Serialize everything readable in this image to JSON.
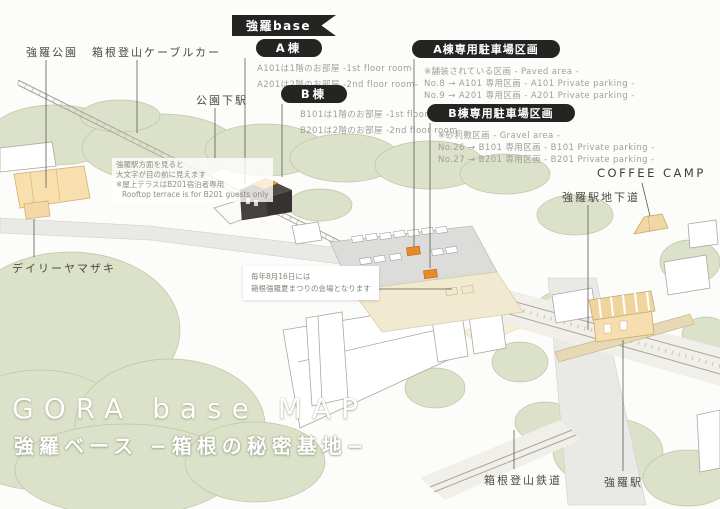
{
  "banner": {
    "title": "強羅base"
  },
  "legend": {
    "building_a": {
      "label": "A棟",
      "lines": [
        "A101は1階のお部屋 -1st floor room-",
        "A201は2階のお部屋 -2nd floor room-"
      ]
    },
    "building_b": {
      "label": "B棟",
      "lines": [
        "B101は1階のお部屋 -1st floor room-",
        "B201は2階のお部屋 -2nd floor room-"
      ]
    },
    "parking_a": {
      "label": "A棟専用駐車場区画",
      "lines": [
        "※舗装されている区画 - Paved area -",
        "No.8 → A101 専用区画  - A101 Private parking -",
        "No.9 → A201 専用区画  - A201 Private parking -"
      ]
    },
    "parking_b": {
      "label": "B棟専用駐車場区画",
      "lines": [
        "※砂利敷区画 - Gravel area -",
        "No.26 → B101 専用区画  - B101 Private parking -",
        "No.27 → B201 専用区画  - B201 Private parking -"
      ]
    }
  },
  "landmarks": {
    "gora_park": "強羅公園",
    "cable_car": "箱根登山ケーブルカー",
    "koen_shimo_station": "公園下駅",
    "daily_yamazaki": "デイリーヤマザキ",
    "coffee_camp": "COFFEE CAMP",
    "gora_underpass": "強羅駅地下道",
    "gora_station": "強羅駅",
    "tozan_railway": "箱根登山鉄道"
  },
  "notes": {
    "rooftop": {
      "line1": "強羅駅方面を見ると",
      "line2": "大文字が目の前に見えます",
      "line3": "※屋上テラスはB201宿泊者専用",
      "line4": "Rooftop terrace is for B201 guests only"
    },
    "festival": {
      "line1": "毎年8月16日には",
      "line2": "箱根強羅夏まつりの会場となります"
    }
  },
  "title": {
    "main": "GORA base MAP",
    "sub": "強羅ベース −箱根の秘密基地−"
  },
  "colors": {
    "label_black": "#262422",
    "highlight_orange": "#e78a2e",
    "tree_green": "#dce2c9",
    "building_tan": "#f6deb0",
    "gravel_tan": "#f2e9d1",
    "paved_gray": "#dcdcda"
  }
}
